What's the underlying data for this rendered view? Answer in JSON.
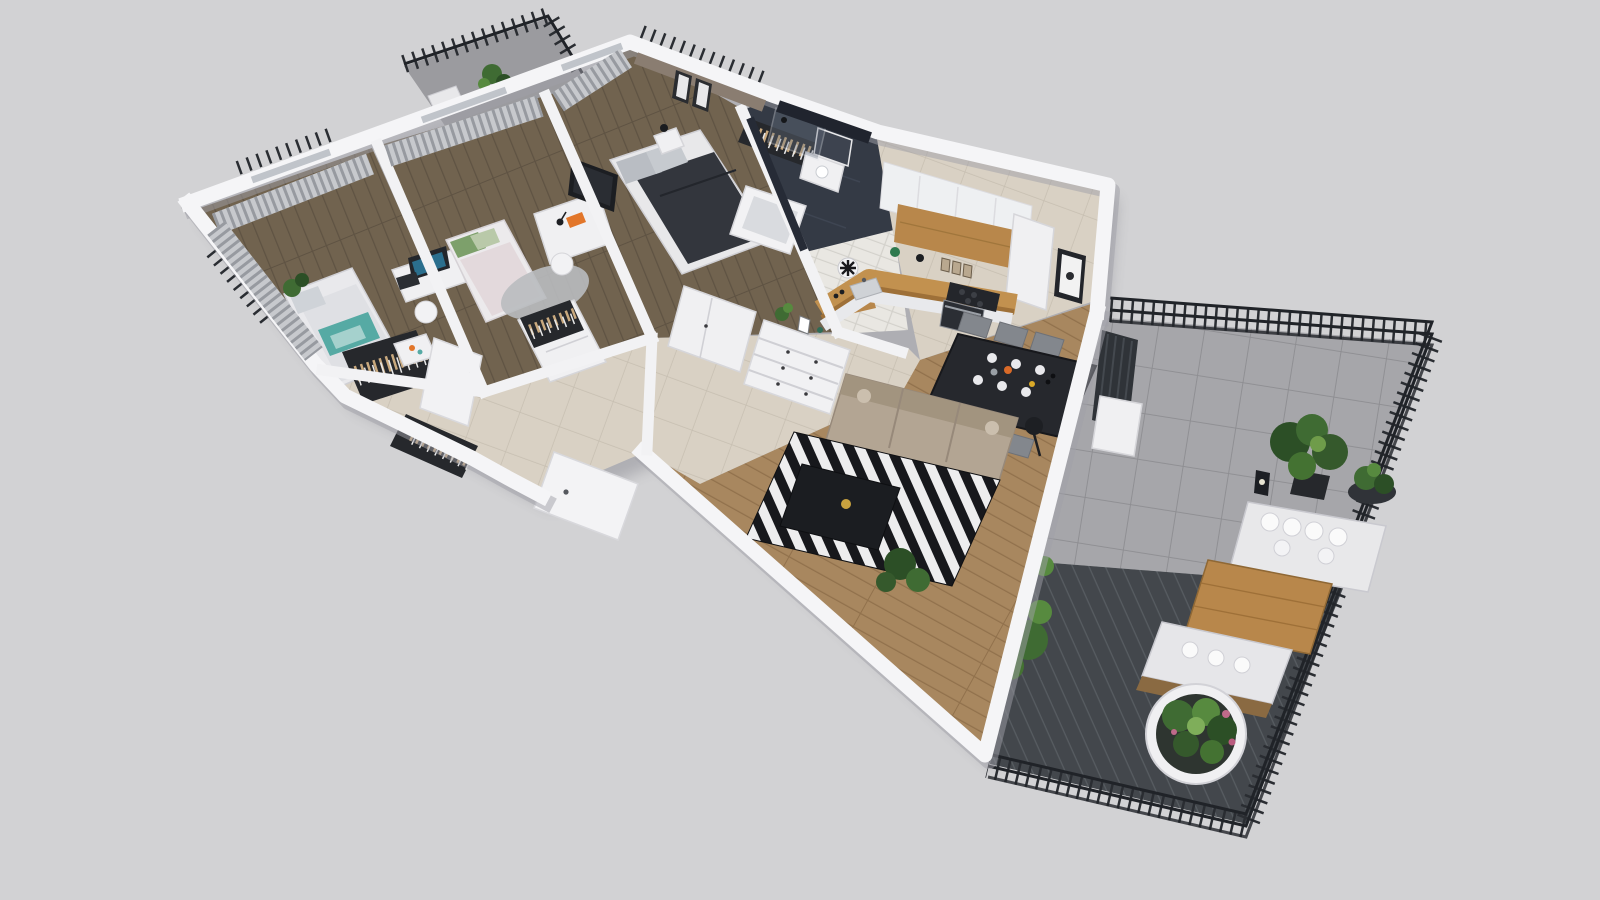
{
  "scene": {
    "type": "3d-floor-plan-render",
    "view": "axonometric top-down cutaway of an apartment",
    "background_color": "#d2d2d4",
    "no_visible_text": true
  },
  "palette": {
    "background": "#d2d2d4",
    "wall_white": "#f5f5f7",
    "wall_shadow": "#9fa0a7",
    "wood_bedroom": "#71634f",
    "wood_living": "#a8875f",
    "tile_beige": "#d9d1c4",
    "tile_gray_terrace": "#a6a6aa",
    "decking_dark": "#43474c",
    "bathroom_dark": "#272b33",
    "curtain_gray": "#9b9ea4",
    "railing_black": "#2a2d32",
    "sofa_beige": "#b3a593",
    "rug_black": "#17181c",
    "rug_white": "#ededee",
    "dining_table_black": "#26282d",
    "chair_gray": "#83878d",
    "counter_wood": "#c2914f",
    "cabinet_white": "#eef0f2",
    "plant_green": "#3f6b33",
    "plant_dark_green": "#2c4f26",
    "accent_teal": "#56aaa4",
    "accent_orange": "#e2762a",
    "taupe_wall": "#8a7d71",
    "bed_duvet_dark": "#33363d"
  },
  "rooms": [
    {
      "id": "bedroom-1",
      "label": "Bedroom 1",
      "floor": "dark wood",
      "contents": [
        "single bed with gray and teal bedding",
        "open wardrobe with clothes",
        "white side table",
        "gray curtains on two window walls",
        "corner plant"
      ]
    },
    {
      "id": "bedroom-2",
      "label": "Bedroom 2",
      "floor": "dark wood",
      "contents": [
        "desk with monitor",
        "white chair",
        "single bed with green and pink pillows",
        "round gray rug",
        "white desk with lamp and orange book",
        "recessed balcony with railing and plant"
      ]
    },
    {
      "id": "master-bedroom",
      "label": "Master bedroom",
      "floor": "dark wood",
      "contents": [
        "double bed with dark duvet",
        "taupe accent wall with two framed prints",
        "nightstand with black lamp",
        "TV panel",
        "wardrobe with clothes"
      ]
    },
    {
      "id": "bathroom",
      "label": "Bathroom",
      "floor": "dark tile",
      "contents": [
        "bathtub",
        "washbasin cabinet with mirror",
        "glass shower screen",
        "dark tiled walls"
      ]
    },
    {
      "id": "shower-room",
      "label": "Shower room / WC",
      "floor": "white tile",
      "contents": [
        "white brick tiled walls",
        "wood shelf",
        "ventilation fan"
      ]
    },
    {
      "id": "hallway",
      "label": "Hallway / entrance",
      "floor": "beige tile",
      "contents": [
        "open wardrobe niche with clothes",
        "white wardrobe unit",
        "tall white cabinet",
        "white chest of drawers with plant and frame",
        "entrance door",
        "open interior door"
      ]
    },
    {
      "id": "kitchen",
      "label": "Kitchen",
      "floor": "beige tile",
      "contents": [
        "white upper cabinets",
        "wood splashback panel",
        "L-shaped wood countertop",
        "induction cooktop",
        "oven",
        "sink",
        "green bowl and jars",
        "framed butterfly picture"
      ]
    },
    {
      "id": "living-dining",
      "label": "Living / dining room",
      "floor": "light wood",
      "contents": [
        "beige three-seat sofa",
        "black-and-white striped rug",
        "black coffee table with gold bowl",
        "black floor lamp",
        "dark dining table set with plates and bowls",
        "six gray chairs",
        "potted plants",
        "glass door to terrace",
        "dark radiator"
      ]
    },
    {
      "id": "terrace",
      "label": "Terrace",
      "floor": "gray tile and dark decking",
      "contents": [
        "black picket railing",
        "white outdoor sofa with pillows",
        "wooden table",
        "bench with white cushions",
        "round white planter bowl with flowers",
        "large potted plants",
        "black lantern"
      ]
    },
    {
      "id": "balcony",
      "label": "Balcony (bedroom 2)",
      "floor": "concrete slab",
      "contents": [
        "black picket railing",
        "potted plant",
        "white lounge seat"
      ]
    }
  ]
}
